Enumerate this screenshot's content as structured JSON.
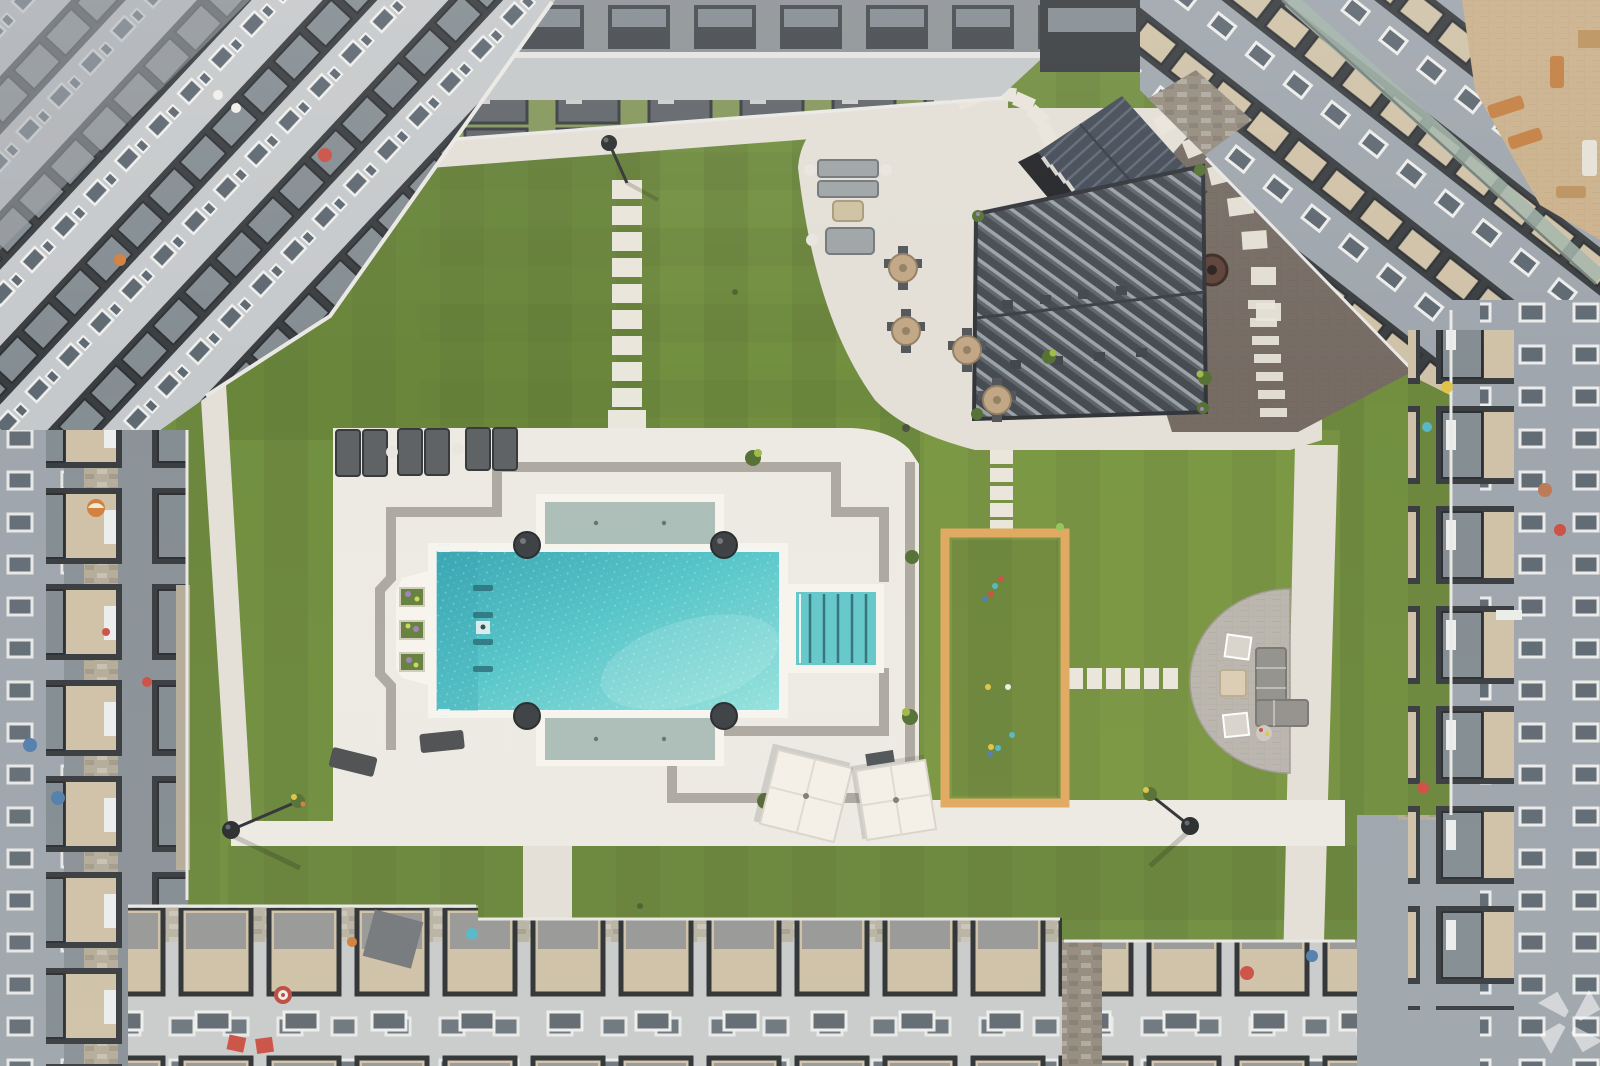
{
  "scene": {
    "type": "aerial-photograph",
    "description": "Aerial drone view of an apartment community courtyard: turquoise swimming pool with sun shelves and step entry, cream pool deck with gray accent stripes, chaise lounges, two white patio umbrellas, artificial turf lawn with stepping-stone paths, an orange-framed bocce court, a slatted metal pergola with dining tables, a dark paver fire-pit terrace, a semicircular paver lounge patio, and surrounding multi-story gray apartment buildings with black-framed balconies.",
    "labels": {
      "lawn": "Artificial turf courtyard lawn",
      "pool": "Swimming pool",
      "pool_deck": "Pool deck with gray accent stripes",
      "sun_shelf": "Pool tanning shelf",
      "pool_steps": "Pool step entry",
      "bocce": "Bocce ball court with orange wood frame",
      "pergola": "Slatted metal pergola over dining area",
      "clubhouse": "Clubhouse structure with standing-seam metal roof",
      "terrace": "Dark paver terrace with fire pit",
      "patio_topright": "Concrete lounge and dining patio",
      "patio_semicircle": "Semicircular paver fire-pit patio",
      "umbrellas": "White patio umbrellas",
      "loungers": "Chaise lounge chairs",
      "walkways": "Concrete walkways",
      "stepping_stones": "Stepping stone paths",
      "lamps": "Globe courtyard lamp posts",
      "building_top": "North apartment building",
      "building_topleft": "Northwest apartment building",
      "building_topright": "Northeast apartment building with rooftop terrace",
      "building_left": "West apartment building with balconies",
      "building_right": "East apartment building with balconies",
      "building_bottom": "South apartment building with balcony pergolas",
      "watermark": "Translucent pinwheel watermark logo"
    },
    "counts": {
      "pool_lane_markers": 4,
      "pool_corner_planters": 4,
      "ledge_flower_planters": 3,
      "chaise_lounges_top_row": 6,
      "chaise_lounges_bottom": 2,
      "patio_umbrellas": 2,
      "round_dining_tables": 4,
      "bocce_balls": 10,
      "stepping_stones_center_path": 9,
      "stepping_stones_bocce_path": 5,
      "stepping_stones_firepit_path": 6,
      "lamp_posts": 3
    }
  },
  "palette": {
    "bg": "#b9bdc0",
    "turf": "#6a8a36",
    "turf-dark": "#55742a",
    "turf-light": "#88a542",
    "walk": "#e2dfd6",
    "deck": "#edebe3",
    "stripe": "#a9a69d",
    "coping": "#f7f5ee",
    "water": "#4cc3c7",
    "water-deep": "#2fa3b0",
    "water-light": "#92e2dd",
    "shelf": "#a8bcb6",
    "step-teal": "#5cc6c8",
    "step-line": "#2b6d74",
    "planter-dark": "#33383b",
    "bocce-frame": "#dfa659",
    "paver": "#b7b3aa",
    "terrace-dark": "#6e655c",
    "white-paver": "#e9e5da",
    "facade-light": "#c3c7ca",
    "facade-mid": "#9aa2a9",
    "facade-dark": "#858d93",
    "balc": "#2f3437",
    "glass": "#55616a",
    "glass2": "#7e888d",
    "glass-green": "#9db3a7",
    "floor-tan": "#cec0a4",
    "stone": "#b2a995",
    "stone-dark": "#8f8779",
    "roof-dark": "#3a434e",
    "roof-rib": "#5d6a77",
    "perg-dark": "#3a4147",
    "perg-light": "#99a2a8",
    "wood": "#b99868",
    "furn-dark": "#4a4f53",
    "furn-gray": "#8f8d88",
    "white": "#f2f0ea",
    "red": "#c9493c",
    "blue": "#4a79a8",
    "teal": "#4fb5c4",
    "yellow": "#ddc23f",
    "orange": "#d07a35",
    "umbrella": "#f4f1e9",
    "lamp": "#1f2325"
  }
}
